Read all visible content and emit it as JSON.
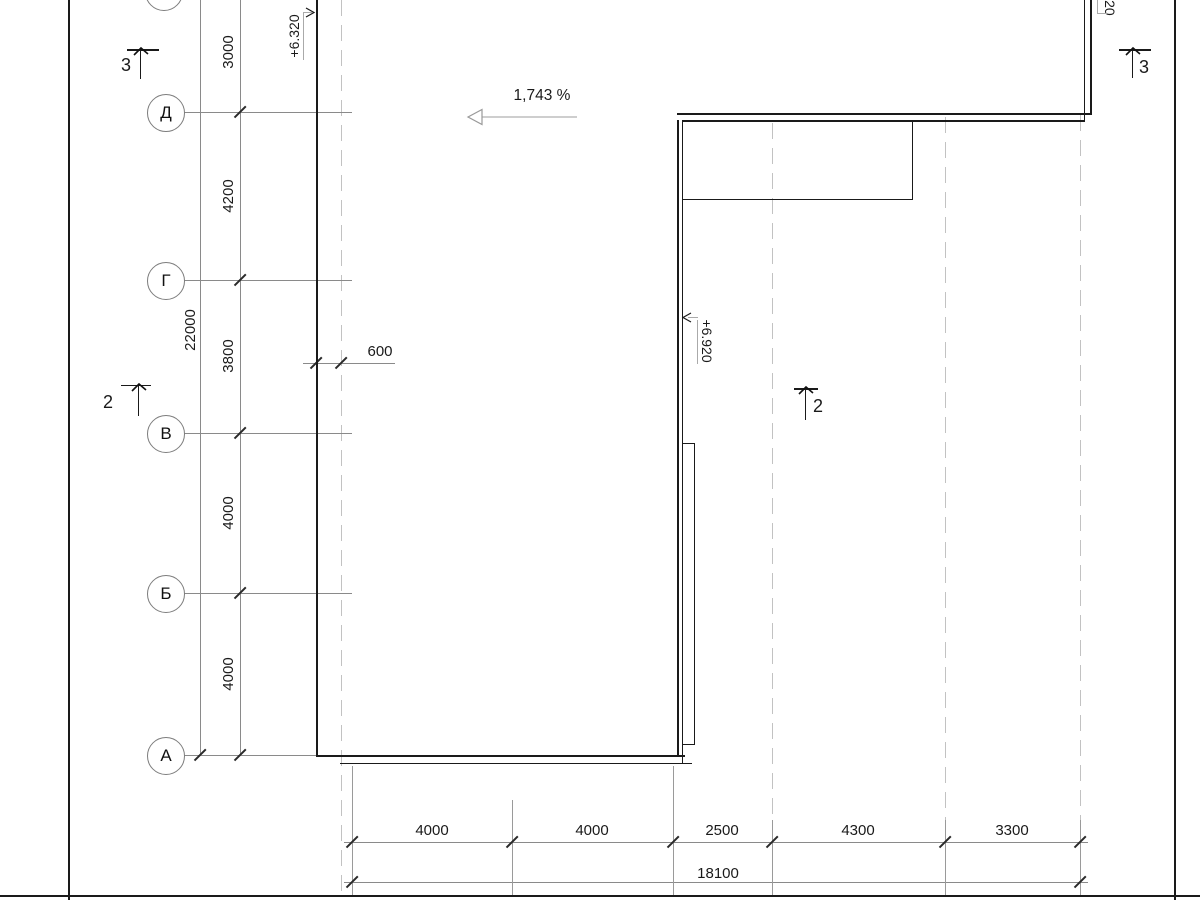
{
  "axes": {
    "row_labels": [
      "Д",
      "Г",
      "В",
      "Б",
      "А"
    ]
  },
  "left_dims": {
    "chain": [
      "3000",
      "4200",
      "3800",
      "4000",
      "4000"
    ],
    "total": "22000",
    "offset": "600"
  },
  "bottom_dims": {
    "chain": [
      "4000",
      "4000",
      "2500",
      "4300",
      "3300"
    ],
    "total": "18100"
  },
  "annotations": {
    "slope": "1,743 %",
    "elev_left": "+6.320",
    "elev_mid": "+6.920",
    "elev_top_right_partial": "920"
  },
  "sections": {
    "top_left": "3",
    "top_right": "3",
    "mid_left": "2",
    "mid_right": "2"
  },
  "colors": {
    "outline": "#1a1a1a",
    "dimension_gray": "#8a8a8a",
    "grid_dash": "#c2c2c2"
  }
}
